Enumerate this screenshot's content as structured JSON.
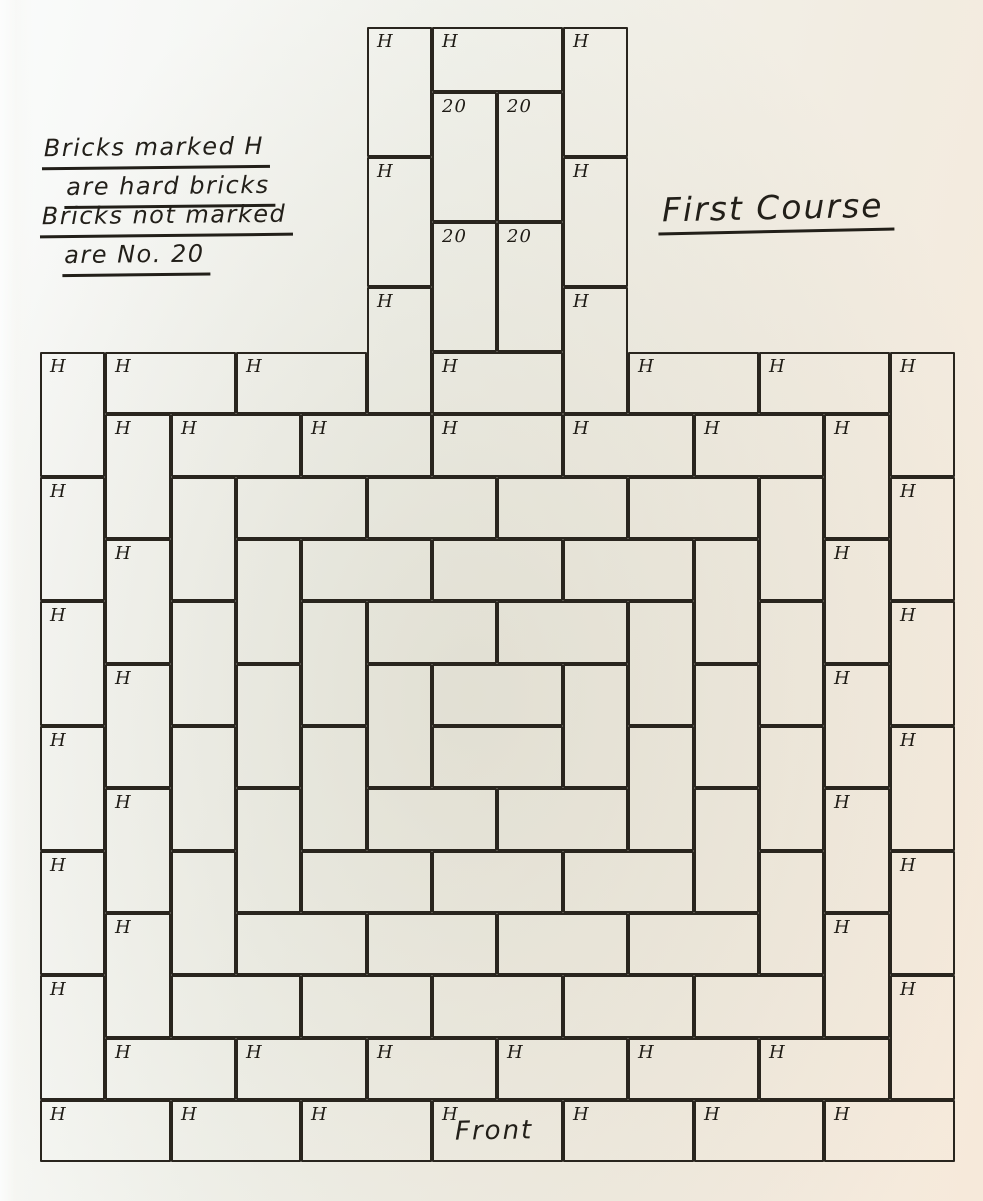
{
  "drawing": {
    "course_title": "First Course",
    "front_label": "Front",
    "legend": {
      "note1_line1": "Bricks marked H",
      "note1_line2": "are hard bricks",
      "note2_line1": "Bricks not marked",
      "note2_line2": "are No. 20"
    },
    "brick_marks": {
      "hard": "H",
      "common": "20"
    },
    "colors": {
      "ink": "#221f19",
      "line": "#29251e",
      "paper_cool": "#fafbfb",
      "paper_mid": "#f1f2ec",
      "paper_warm": "#f6e9da"
    },
    "bricks": [
      [
        367,
        27,
        65,
        130,
        "H"
      ],
      [
        563,
        27,
        65,
        130,
        "H"
      ],
      [
        432,
        27,
        131,
        65,
        "H"
      ],
      [
        432,
        92,
        65,
        130,
        "20"
      ],
      [
        497,
        92,
        66,
        130,
        "20"
      ],
      [
        367,
        157,
        65,
        130,
        "H"
      ],
      [
        563,
        157,
        65,
        130,
        "H"
      ],
      [
        432,
        222,
        65,
        130,
        "20"
      ],
      [
        497,
        222,
        66,
        130,
        "20"
      ],
      [
        367,
        287,
        65,
        127,
        "H"
      ],
      [
        563,
        287,
        65,
        127,
        "H"
      ],
      [
        105,
        352,
        131,
        62,
        "H"
      ],
      [
        236,
        352,
        131,
        62,
        "H"
      ],
      [
        432,
        352,
        131,
        62,
        "H"
      ],
      [
        628,
        352,
        131,
        62,
        "H"
      ],
      [
        759,
        352,
        131,
        62,
        "H"
      ],
      [
        40,
        352,
        65,
        125,
        "H"
      ],
      [
        40,
        477,
        65,
        124,
        "H"
      ],
      [
        40,
        601,
        65,
        125,
        "H"
      ],
      [
        40,
        726,
        65,
        125,
        "H"
      ],
      [
        40,
        851,
        65,
        124,
        "H"
      ],
      [
        40,
        975,
        65,
        125,
        "H"
      ],
      [
        890,
        352,
        65,
        125,
        "H"
      ],
      [
        890,
        477,
        65,
        124,
        "H"
      ],
      [
        890,
        601,
        65,
        125,
        "H"
      ],
      [
        890,
        726,
        65,
        125,
        "H"
      ],
      [
        890,
        851,
        65,
        124,
        "H"
      ],
      [
        890,
        975,
        65,
        125,
        "H"
      ],
      [
        40,
        1100,
        131,
        62,
        "H"
      ],
      [
        171,
        1100,
        130,
        62,
        "H"
      ],
      [
        301,
        1100,
        131,
        62,
        "H"
      ],
      [
        432,
        1100,
        131,
        62,
        "H"
      ],
      [
        563,
        1100,
        131,
        62,
        "H"
      ],
      [
        694,
        1100,
        130,
        62,
        "H"
      ],
      [
        824,
        1100,
        131,
        62,
        "H"
      ],
      [
        105,
        414,
        66,
        125,
        "H"
      ],
      [
        105,
        539,
        66,
        125,
        "H"
      ],
      [
        105,
        664,
        66,
        124,
        "H"
      ],
      [
        105,
        788,
        66,
        125,
        "H"
      ],
      [
        105,
        913,
        66,
        125,
        "H"
      ],
      [
        171,
        414,
        130,
        63,
        "H"
      ],
      [
        301,
        414,
        131,
        63,
        "H"
      ],
      [
        432,
        414,
        131,
        63,
        "H"
      ],
      [
        563,
        414,
        131,
        63,
        "H"
      ],
      [
        694,
        414,
        130,
        63,
        "H"
      ],
      [
        824,
        414,
        66,
        125,
        "H"
      ],
      [
        824,
        539,
        66,
        125,
        "H"
      ],
      [
        824,
        664,
        66,
        124,
        "H"
      ],
      [
        824,
        788,
        66,
        125,
        "H"
      ],
      [
        824,
        913,
        66,
        125,
        "H"
      ],
      [
        105,
        1038,
        131,
        62,
        "H"
      ],
      [
        236,
        1038,
        131,
        62,
        "H"
      ],
      [
        367,
        1038,
        130,
        62,
        "H"
      ],
      [
        497,
        1038,
        131,
        62,
        "H"
      ],
      [
        628,
        1038,
        131,
        62,
        "H"
      ],
      [
        759,
        1038,
        131,
        62,
        "H"
      ],
      [
        171,
        477,
        65,
        124,
        ""
      ],
      [
        171,
        601,
        65,
        125,
        ""
      ],
      [
        171,
        726,
        65,
        125,
        ""
      ],
      [
        171,
        851,
        65,
        124,
        ""
      ],
      [
        236,
        477,
        131,
        62,
        ""
      ],
      [
        367,
        477,
        130,
        62,
        ""
      ],
      [
        497,
        477,
        131,
        62,
        ""
      ],
      [
        628,
        477,
        131,
        62,
        ""
      ],
      [
        759,
        477,
        65,
        124,
        ""
      ],
      [
        759,
        601,
        65,
        125,
        ""
      ],
      [
        759,
        726,
        65,
        125,
        ""
      ],
      [
        759,
        851,
        65,
        124,
        ""
      ],
      [
        171,
        975,
        130,
        63,
        ""
      ],
      [
        301,
        975,
        131,
        63,
        ""
      ],
      [
        432,
        975,
        131,
        63,
        ""
      ],
      [
        563,
        975,
        131,
        63,
        ""
      ],
      [
        694,
        975,
        130,
        63,
        ""
      ],
      [
        236,
        539,
        65,
        125,
        ""
      ],
      [
        236,
        664,
        65,
        124,
        ""
      ],
      [
        236,
        788,
        65,
        125,
        ""
      ],
      [
        301,
        539,
        131,
        62,
        ""
      ],
      [
        432,
        539,
        131,
        62,
        ""
      ],
      [
        563,
        539,
        131,
        62,
        ""
      ],
      [
        694,
        539,
        65,
        125,
        ""
      ],
      [
        694,
        664,
        65,
        124,
        ""
      ],
      [
        694,
        788,
        65,
        125,
        ""
      ],
      [
        236,
        913,
        131,
        62,
        ""
      ],
      [
        367,
        913,
        130,
        62,
        ""
      ],
      [
        497,
        913,
        131,
        62,
        ""
      ],
      [
        628,
        913,
        131,
        62,
        ""
      ],
      [
        301,
        601,
        66,
        125,
        ""
      ],
      [
        301,
        726,
        66,
        125,
        ""
      ],
      [
        367,
        601,
        130,
        63,
        ""
      ],
      [
        497,
        601,
        131,
        63,
        ""
      ],
      [
        628,
        601,
        66,
        125,
        ""
      ],
      [
        628,
        726,
        66,
        125,
        ""
      ],
      [
        301,
        851,
        131,
        62,
        ""
      ],
      [
        432,
        851,
        131,
        62,
        ""
      ],
      [
        563,
        851,
        131,
        62,
        ""
      ],
      [
        367,
        664,
        65,
        124,
        ""
      ],
      [
        432,
        664,
        131,
        62,
        ""
      ],
      [
        563,
        664,
        65,
        124,
        ""
      ],
      [
        367,
        788,
        130,
        63,
        ""
      ],
      [
        497,
        788,
        131,
        63,
        ""
      ],
      [
        432,
        726,
        131,
        62,
        ""
      ]
    ]
  }
}
